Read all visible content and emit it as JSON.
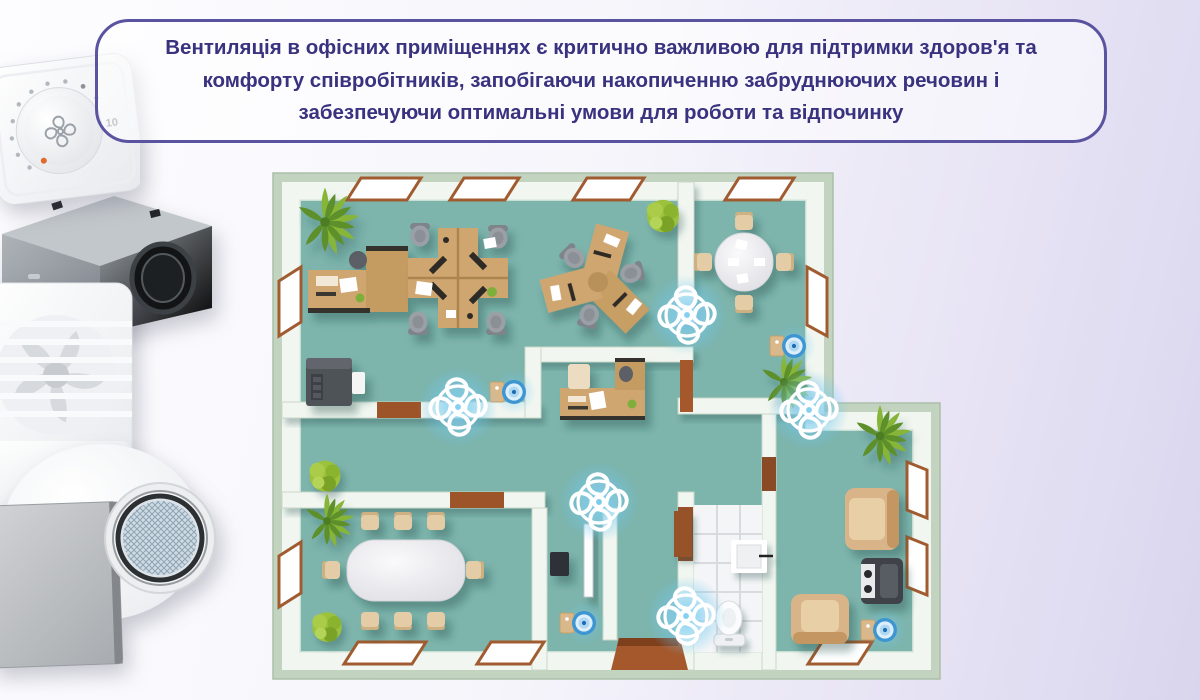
{
  "banner": {
    "lines": [
      "Вентиляція в офісних приміщеннях є критично важливою для підтримки здоров'я та",
      "комфорту співробітників, запобігаючи накопиченню забруднюючих речовин і",
      "забезпечуючи оптимальні умови для роботи та відпочинку"
    ],
    "text_color": "#39327f",
    "border_color": "#5a53a0"
  },
  "products": {
    "controller_dial_label": "10",
    "items": [
      "fan-speed-controller",
      "duct-filter-box",
      "wall-mounted-fan",
      "inline-duct-fan"
    ]
  },
  "floorplan": {
    "floor_color": "#7db4ac",
    "wall_face_color": "#f1f6f0",
    "wall_edge_color": "#c2d3c0",
    "window_frame_color": "#a05c30",
    "door_color": "#a4582c",
    "desk_wood_color": "#cfa670",
    "glow_color": "#6ec8f0",
    "fan_markers": [
      {
        "x": 417,
        "y": 145
      },
      {
        "x": 188,
        "y": 237
      },
      {
        "x": 539,
        "y": 240
      },
      {
        "x": 329,
        "y": 332
      },
      {
        "x": 416,
        "y": 446
      }
    ],
    "purifier_markers": [
      {
        "x": 244,
        "y": 222
      },
      {
        "x": 524,
        "y": 176
      },
      {
        "x": 314,
        "y": 453
      },
      {
        "x": 615,
        "y": 460
      }
    ]
  }
}
